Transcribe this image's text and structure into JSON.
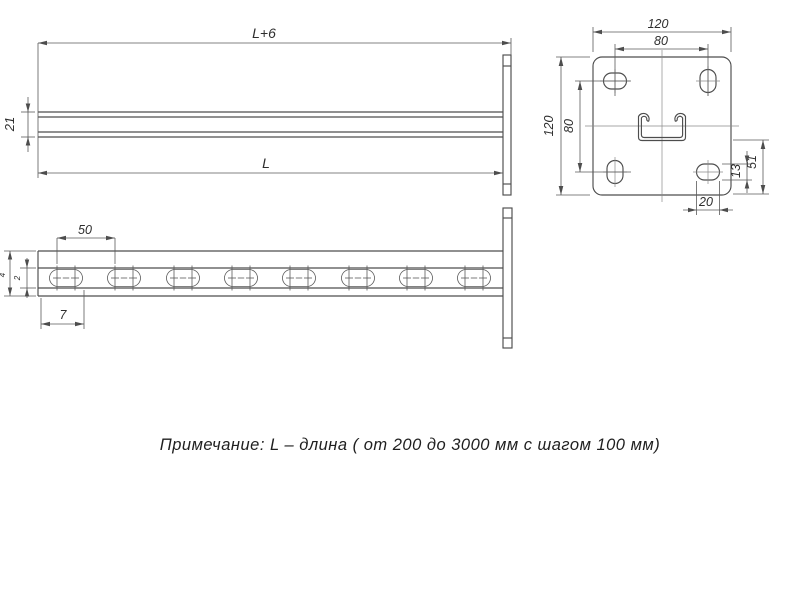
{
  "drawing": {
    "note": "Примечание: L – длина ( от 200 до 3000 мм с шагом 100 мм)",
    "front_view": {
      "dim_overall_length": "L+6",
      "dim_profile_height": "21",
      "dim_length": "L"
    },
    "top_view": {
      "dim_slot_pitch": "50",
      "dim_end_offset": "7",
      "dim_outer": "4",
      "dim_inner": "2"
    },
    "end_view": {
      "dim_plate_width": "120",
      "dim_hole_spacing_horizontal": "80",
      "dim_plate_height": "120",
      "dim_hole_spacing_vertical": "80",
      "dim_hole_to_edge": "51",
      "dim_hole_height": "13",
      "dim_hole_width": "20"
    },
    "line_color": "#4d4d4d"
  }
}
